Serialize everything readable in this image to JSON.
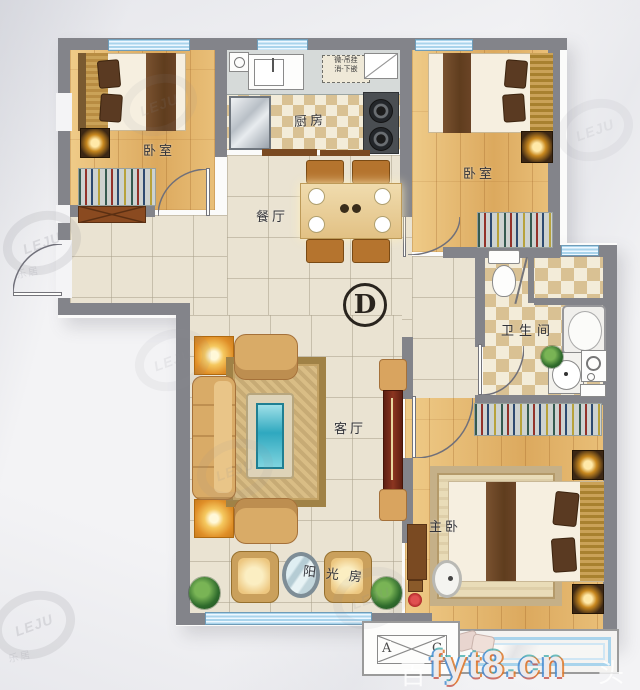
{
  "plan": {
    "unit_badge": {
      "letter": "D"
    },
    "rooms": {
      "bedroom_tl": {
        "label": "卧室"
      },
      "bedroom_tr": {
        "label": "卧室"
      },
      "kitchen": {
        "label": "厨房",
        "note_line1": "微-吊挂",
        "note_line2": "消-下嵌"
      },
      "dining": {
        "label": "餐厅"
      },
      "living": {
        "label": "客厅"
      },
      "bathroom": {
        "label": "卫生间"
      },
      "master": {
        "label": "主卧"
      },
      "sunroom": {
        "label": "阳光房"
      }
    },
    "legend": {
      "left": "A",
      "right": "C"
    }
  },
  "watermarks": {
    "logo": "LEJU",
    "logo_cn": "乐居",
    "site": "fyt8.cn",
    "back_left": "百",
    "back_right": "头"
  },
  "colors": {
    "wall": "#83848a",
    "window_blue": "#a9d4ec",
    "wood_floor": "#e8c07d",
    "tile_floor": "#eae3d2",
    "checker_tile": "#d9c193",
    "sofa_tan": "#d9ab67",
    "tv_cabinet_red": "#7a2b1a",
    "glass_teal": "#3fc0d0",
    "lamp_glow": "#f2a432",
    "plant_green": "#2f6b2c",
    "badge_ink": "#29241e"
  }
}
